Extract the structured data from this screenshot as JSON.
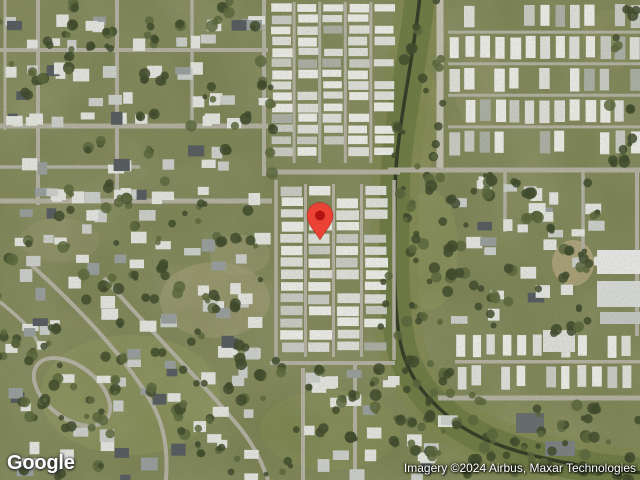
{
  "map": {
    "logo": "Google",
    "attribution": "Imagery ©2024 Airbus, Maxar Technologies",
    "pin": {
      "x": 320,
      "y": 240,
      "color": "#EA4335",
      "dot": "#B31412"
    },
    "palette": {
      "base": "#78804f",
      "road": "#b6b3a5",
      "road_bright": "#c6c3b4",
      "tree_dark": "#3e4a2c",
      "tree_mid": "#5a673c",
      "canal_water": "#2d3823",
      "canal_band": "#6d7a43",
      "canal_band_soft": "#7f884c",
      "home_white": "#f1f1ed",
      "house_white": "#e8e9e5"
    },
    "patches": [
      {
        "cx": 215,
        "cy": 300,
        "rx": 55,
        "ry": 38,
        "f": "#a89f79",
        "o": 0.5
      },
      {
        "cx": 240,
        "cy": 255,
        "rx": 30,
        "ry": 20,
        "f": "#a89f79",
        "o": 0.4
      },
      {
        "cx": 60,
        "cy": 240,
        "rx": 40,
        "ry": 22,
        "f": "#97916c",
        "o": 0.4
      },
      {
        "cx": 130,
        "cy": 395,
        "rx": 90,
        "ry": 60,
        "f": "#8e9858",
        "o": 0.45
      },
      {
        "cx": 330,
        "cy": 430,
        "rx": 70,
        "ry": 40,
        "f": "#87914f",
        "o": 0.4
      },
      {
        "cx": 573,
        "cy": 263,
        "rx": 21,
        "ry": 23,
        "f": "#b9a87f",
        "o": 0.9
      },
      {
        "cx": 480,
        "cy": 90,
        "rx": 25,
        "ry": 40,
        "f": "#9a9a6e",
        "o": 0.3
      },
      {
        "cx": 610,
        "cy": 40,
        "rx": 28,
        "ry": 30,
        "f": "#8e9461",
        "o": 0.35
      },
      {
        "cx": 430,
        "cy": 250,
        "rx": 28,
        "ry": 60,
        "f": "#8c9355",
        "o": 0.5
      },
      {
        "cx": 500,
        "cy": 440,
        "rx": 80,
        "ry": 36,
        "f": "#79834a",
        "o": 0.5
      },
      {
        "cx": 420,
        "cy": 120,
        "rx": 20,
        "ry": 55,
        "f": "#89914f",
        "o": 0.5
      }
    ],
    "canal": {
      "d": "M420,-4 C412,70 396,130 395,190 C394,250 393,295 399,335 C405,375 425,398 455,422 C488,447 545,461 605,469 L644,473",
      "band_w": 30,
      "band2_w": 48,
      "line_w": 3.5
    },
    "roads": [
      {
        "d": "M0,50 H268",
        "w": 4
      },
      {
        "d": "M0,126 H268",
        "w": 5
      },
      {
        "d": "M0,167 H140",
        "w": 3.5
      },
      {
        "d": "M0,201 H272",
        "w": 5
      },
      {
        "d": "M5,0 V130",
        "w": 3
      },
      {
        "d": "M38,0 V205",
        "w": 4
      },
      {
        "d": "M117,0 V203",
        "w": 4
      },
      {
        "d": "M192,0 V126",
        "w": 3.5
      },
      {
        "d": "M264,0 V176",
        "w": 4
      },
      {
        "d": "M262,172 H400",
        "w": 5
      },
      {
        "d": "M440,-3 V172",
        "w": 7,
        "c": "#c6c3b4"
      },
      {
        "d": "M388,170 H640",
        "w": 5
      },
      {
        "d": "M505,172 V232",
        "w": 3.5
      },
      {
        "d": "M583,172 V262",
        "w": 3.5
      },
      {
        "d": "M637,172 V336",
        "w": 4
      },
      {
        "d": "M438,398 H640",
        "w": 5
      },
      {
        "d": "M276,180 V360",
        "w": 3.5
      },
      {
        "d": "M394,180 V360",
        "w": 3.5
      },
      {
        "d": "M270,363 H395",
        "w": 4
      },
      {
        "d": "M303,368 V480",
        "w": 4
      },
      {
        "d": "M355,364 V480",
        "w": 4
      },
      {
        "d": "M455,362 H642",
        "w": 3
      },
      {
        "d": "M28,262 C70,300 122,352 150,400 C165,425 168,452 166,480",
        "w": 4
      },
      {
        "d": "M104,278 C150,330 200,380 240,428 C252,443 262,462 268,480",
        "w": 4
      },
      {
        "d": "M0,302 C20,318 36,332 40,350",
        "w": 3.5
      }
    ],
    "oval_street": {
      "cx": 72,
      "cy": 392,
      "rx": 44,
      "ry": 26,
      "rot": 38
    },
    "mobile_parks": [
      {
        "o": "v",
        "x": 270,
        "y": 2,
        "x2": 398,
        "y2": 163,
        "colW": 26,
        "hH": 8,
        "gap": 3
      },
      {
        "o": "v",
        "x": 279,
        "y": 184,
        "x2": 391,
        "y2": 357,
        "colW": 28,
        "hH": 9,
        "gap": 3
      },
      {
        "o": "h",
        "x": 448,
        "y": 2,
        "x2": 642,
        "y2": 160,
        "rowH": 32,
        "hW": 10,
        "gap": 5
      },
      {
        "o": "h",
        "x": 455,
        "y": 332,
        "x2": 642,
        "y2": 394,
        "rowH": 31,
        "hW": 9,
        "gap": 6
      }
    ],
    "suburb_zones": [
      {
        "x": 2,
        "y": 4,
        "w": 258,
        "h": 192,
        "n": 75,
        "rows": [
          14,
          34,
          62,
          90,
          110,
          140,
          158,
          186
        ]
      },
      {
        "x": 2,
        "y": 205,
        "w": 266,
        "h": 270,
        "n": 85
      },
      {
        "x": 263,
        "y": 368,
        "w": 180,
        "h": 106,
        "n": 26
      },
      {
        "x": 450,
        "y": 176,
        "w": 145,
        "h": 150,
        "n": 30
      }
    ],
    "buildings": [
      {
        "x": 597,
        "y": 250,
        "w": 45,
        "h": 24,
        "f": "#eceded"
      },
      {
        "x": 597,
        "y": 281,
        "w": 45,
        "h": 26,
        "f": "#dcdedd"
      },
      {
        "x": 600,
        "y": 312,
        "w": 40,
        "h": 12,
        "f": "#c8cac8"
      },
      {
        "x": 543,
        "y": 330,
        "w": 32,
        "h": 22,
        "f": "#e2e3de"
      },
      {
        "x": 516,
        "y": 413,
        "w": 28,
        "h": 20,
        "f": "#686d70"
      },
      {
        "x": 545,
        "y": 441,
        "w": 30,
        "h": 15,
        "f": "#7c8183"
      }
    ],
    "tree_zones": [
      {
        "x": 0,
        "y": 0,
        "w": 265,
        "h": 200,
        "n": 45
      },
      {
        "x": 0,
        "y": 200,
        "w": 270,
        "h": 278,
        "n": 95
      },
      {
        "x": 270,
        "y": 362,
        "w": 180,
        "h": 116,
        "n": 26
      },
      {
        "x": 448,
        "y": 172,
        "w": 150,
        "h": 160,
        "n": 38
      },
      {
        "x": 455,
        "y": 400,
        "w": 185,
        "h": 78,
        "n": 42
      },
      {
        "x": 395,
        "y": 0,
        "w": 48,
        "h": 172,
        "n": 16
      },
      {
        "x": 383,
        "y": 172,
        "w": 70,
        "h": 190,
        "n": 28
      },
      {
        "x": 400,
        "y": 355,
        "w": 90,
        "h": 70,
        "n": 14
      },
      {
        "x": 600,
        "y": 0,
        "w": 38,
        "h": 165,
        "n": 10
      },
      {
        "x": 262,
        "y": 0,
        "w": 14,
        "h": 178,
        "n": 6
      }
    ]
  }
}
